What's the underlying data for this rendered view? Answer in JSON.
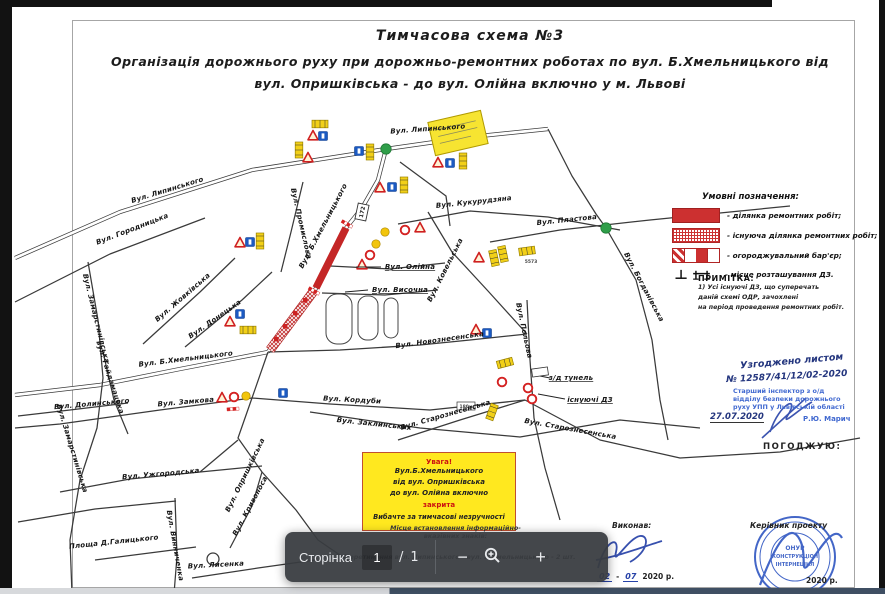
{
  "page": {
    "title1": "Тимчасова схема №3",
    "title2": "Організація дорожнього руху при дорожньо-ремонтних роботах по вул. Б.Хмельницького від",
    "title3": "вул. Опришківська - до вул. Олійна включно у м. Львові"
  },
  "legend": {
    "title": "Умовні позначення:",
    "items": [
      {
        "label": "- ділянка ремонтних робіт;"
      },
      {
        "label": "- існуюча ділянка ремонтних робіт;"
      },
      {
        "label": "- огороджувальний бар'єр;"
      },
      {
        "label": "- місце розташування ДЗ."
      }
    ],
    "note_title": "ПРИМІТКА:",
    "note_lines": [
      "1) Усі існуючі ДЗ, що суперечать",
      "даній схемі ОДР, зачохлені",
      "на період проведення ремонтних робіт."
    ]
  },
  "map": {
    "labels": [
      "Вул. Липинського",
      "Вул. Липинського",
      "Вул. Городницька",
      "Вул. Промислова",
      "Вул. Б.Хмельницького",
      "Вул. Кукурудзяна",
      "Вул. Пластова",
      "Вул. Ковельська",
      "Вул. Олійна",
      "Вул. Височна",
      "Вул. Богданівська",
      "Вул. Польова",
      "Вул. Новознесенська",
      "Вул. Старознесенська",
      "Вул. Старознесенська",
      "з/д тунель",
      "існуючі ДЗ",
      "Вул. Жовківська",
      "Вул. Донецька",
      "Вул. Б.Хмельницького",
      "Вул. Замкова",
      "Вул. Кордуби",
      "Вул. Заклинських",
      "Вул. Опришківська",
      "Вул. Замарстинівська",
      "вул. Гайдамацька",
      "Вул. Долинського",
      "Вул. Ужгородська",
      "Площа Д.Галицького",
      "Вул. Винниченка",
      "Вул. Кривоноса",
      "Вул. Лисенка",
      "Вул. Замарстинівська"
    ],
    "codes": {
      "shield": "172",
      "sign_id": "5573",
      "tunnel_length": "180м"
    }
  },
  "notice": {
    "heading": "Увага!",
    "line1": "Вул.Б.Хмельницького",
    "line2": "від вул. Опришківська",
    "line3": "до вул. Олійна включно",
    "closed": "закрита",
    "apology": "Вибачте за тимчасові незручності"
  },
  "approval": {
    "letter_line1": "Узгоджено листом",
    "letter_line2": "№ 12587/41/12/02-2020",
    "stamp_line1": "Старший інспектор з о/д",
    "stamp_line2": "відділу безпеки дорожнього",
    "stamp_line3": "руху УПП у Львівській області",
    "date": "27.07.2020",
    "name": "Р.Ю. Марич",
    "agree_label": "ПОГОДЖУЮ:"
  },
  "footer": {
    "executor_label": "Виконав:",
    "executor_day": "02",
    "executor_month": "07",
    "executor_year": "2020 р.",
    "manager_label": "Керівник проекту",
    "stamp_line1": "ОНУР",
    "stamp_line2": "КОНСТРУКЦІОН",
    "stamp_line3": "ІНТЕРНЕШНЛ",
    "stamp_year": "2020 р.",
    "note_line1": "Місце встановлення інформаційно-",
    "note_line2": "вказівних знаків:",
    "note_line3": "1) Перетинання вул. Липинського - вул. Б.Хмельницького - 2 шт."
  },
  "toolbar": {
    "page_label": "Сторінка",
    "current_page": "1",
    "separator": "/",
    "total_pages": "1",
    "zoom_out": "−",
    "zoom_in": "+"
  }
}
